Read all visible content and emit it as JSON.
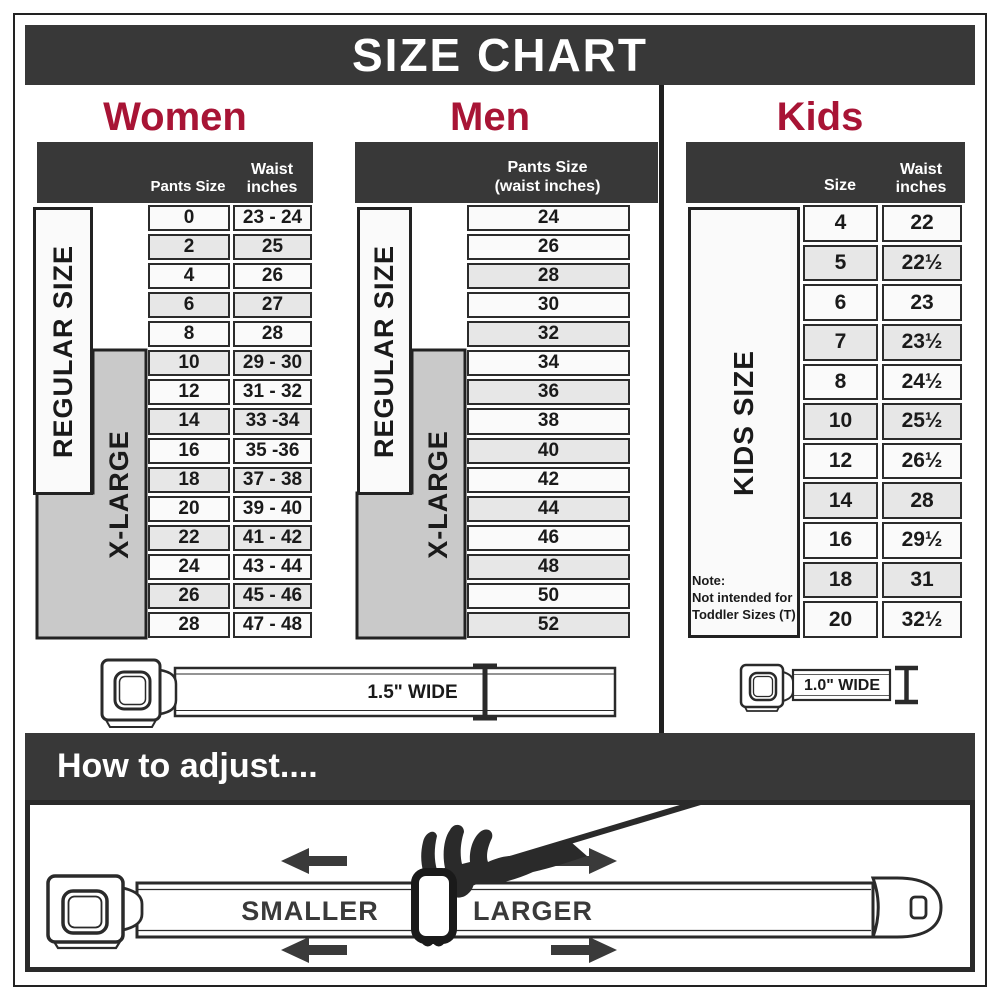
{
  "page": {
    "title": "SIZE CHART"
  },
  "colors": {
    "accent_red": "#A81435",
    "bar_dark": "#383838",
    "row_light": "#FAFAFA",
    "row_shaded": "#E7E7E7",
    "xlarge_gray": "#C9C9C9"
  },
  "women": {
    "title": "Women",
    "col_pants": "Pants Size",
    "col_waist_line1": "Waist",
    "col_waist_line2": "inches",
    "regular_label": "REGULAR SIZE",
    "xlarge_label": "X-LARGE",
    "rows": [
      {
        "size": "0",
        "waist": "23 - 24"
      },
      {
        "size": "2",
        "waist": "25"
      },
      {
        "size": "4",
        "waist": "26"
      },
      {
        "size": "6",
        "waist": "27"
      },
      {
        "size": "8",
        "waist": "28"
      },
      {
        "size": "10",
        "waist": "29 - 30"
      },
      {
        "size": "12",
        "waist": "31 - 32"
      },
      {
        "size": "14",
        "waist": "33 -34"
      },
      {
        "size": "16",
        "waist": "35 -36"
      },
      {
        "size": "18",
        "waist": "37 - 38"
      },
      {
        "size": "20",
        "waist": "39 - 40"
      },
      {
        "size": "22",
        "waist": "41 - 42"
      },
      {
        "size": "24",
        "waist": "43 - 44"
      },
      {
        "size": "26",
        "waist": "45 - 46"
      },
      {
        "size": "28",
        "waist": "47 - 48"
      }
    ]
  },
  "men": {
    "title": "Men",
    "header_line1": "Pants Size",
    "header_line2": "(waist inches)",
    "regular_label": "REGULAR SIZE",
    "xlarge_label": "X-LARGE",
    "rows": [
      "24",
      "26",
      "28",
      "30",
      "32",
      "34",
      "36",
      "38",
      "40",
      "42",
      "44",
      "46",
      "48",
      "50",
      "52"
    ]
  },
  "kids": {
    "title": "Kids",
    "col_size": "Size",
    "col_waist_line1": "Waist",
    "col_waist_line2": "inches",
    "label": "KIDS SIZE",
    "note_line1": "Note:",
    "note_line2": "Not intended for",
    "note_line3": "Toddler Sizes (T)",
    "rows": [
      {
        "size": "4",
        "waist": "22"
      },
      {
        "size": "5",
        "waist": "22½"
      },
      {
        "size": "6",
        "waist": "23"
      },
      {
        "size": "7",
        "waist": "23½"
      },
      {
        "size": "8",
        "waist": "24½"
      },
      {
        "size": "10",
        "waist": "25½"
      },
      {
        "size": "12",
        "waist": "26½"
      },
      {
        "size": "14",
        "waist": "28"
      },
      {
        "size": "16",
        "waist": "29½"
      },
      {
        "size": "18",
        "waist": "31"
      },
      {
        "size": "20",
        "waist": "32½"
      }
    ]
  },
  "belts": {
    "adult_width_label": "1.5\" WIDE",
    "kids_width_label": "1.0\" WIDE"
  },
  "adjust": {
    "title": "How to adjust....",
    "smaller_label": "SMALLER",
    "larger_label": "LARGER"
  },
  "chart_data": [
    {
      "type": "table",
      "title": "Women",
      "columns": [
        "Pants Size",
        "Waist inches"
      ],
      "rows": [
        [
          "0",
          "23 - 24"
        ],
        [
          "2",
          "25"
        ],
        [
          "4",
          "26"
        ],
        [
          "6",
          "27"
        ],
        [
          "8",
          "28"
        ],
        [
          "10",
          "29 - 30"
        ],
        [
          "12",
          "31 - 32"
        ],
        [
          "14",
          "33 -34"
        ],
        [
          "16",
          "35 -36"
        ],
        [
          "18",
          "37 - 38"
        ],
        [
          "20",
          "39 - 40"
        ],
        [
          "22",
          "41 - 42"
        ],
        [
          "24",
          "43 - 44"
        ],
        [
          "26",
          "45 - 46"
        ],
        [
          "28",
          "47 - 48"
        ]
      ],
      "annotations": [
        "REGULAR SIZE spans pants sizes 0-18",
        "X-LARGE spans pants sizes 10-28",
        "Belt width 1.5\" WIDE"
      ]
    },
    {
      "type": "table",
      "title": "Men",
      "columns": [
        "Pants Size (waist inches)"
      ],
      "rows": [
        [
          "24"
        ],
        [
          "26"
        ],
        [
          "28"
        ],
        [
          "30"
        ],
        [
          "32"
        ],
        [
          "34"
        ],
        [
          "36"
        ],
        [
          "38"
        ],
        [
          "40"
        ],
        [
          "42"
        ],
        [
          "44"
        ],
        [
          "46"
        ],
        [
          "48"
        ],
        [
          "50"
        ],
        [
          "52"
        ]
      ],
      "annotations": [
        "REGULAR SIZE spans sizes 24-42",
        "X-LARGE spans sizes 34-52",
        "Belt width 1.5\" WIDE"
      ]
    },
    {
      "type": "table",
      "title": "Kids",
      "columns": [
        "Size",
        "Waist inches"
      ],
      "rows": [
        [
          "4",
          "22"
        ],
        [
          "5",
          "22½"
        ],
        [
          "6",
          "23"
        ],
        [
          "7",
          "23½"
        ],
        [
          "8",
          "24½"
        ],
        [
          "10",
          "25½"
        ],
        [
          "12",
          "26½"
        ],
        [
          "14",
          "28"
        ],
        [
          "16",
          "29½"
        ],
        [
          "18",
          "31"
        ],
        [
          "20",
          "32½"
        ]
      ],
      "annotations": [
        "KIDS SIZE",
        "Note: Not intended for Toddler Sizes (T)",
        "Belt width 1.0\" WIDE"
      ]
    }
  ]
}
